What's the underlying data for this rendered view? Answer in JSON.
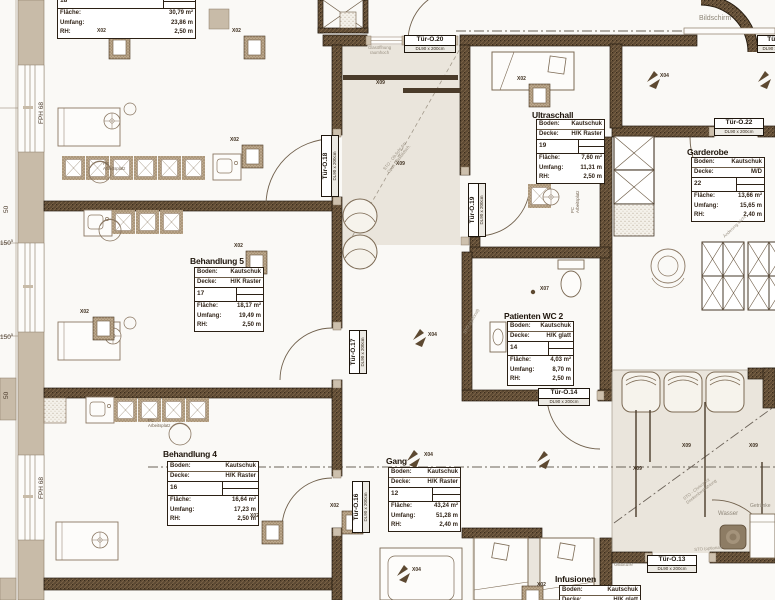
{
  "drawing": {
    "box_labels": {
      "boden": "Boden:",
      "decke": "Decke:",
      "flaeche": "Fläche:",
      "umfang": "Umfang:",
      "rh": "RH:"
    },
    "rooms": [
      {
        "id": "raum18",
        "title": "",
        "number": "18",
        "flaeche": "30,79 m²",
        "umfang": "23,86 m",
        "rh": "2,50 m"
      },
      {
        "id": "behandlung5",
        "title": "Behandlung 5",
        "boden": "Kautschuk",
        "decke": "H/K Raster",
        "number": "17",
        "flaeche": "18,17 m²",
        "umfang": "19,49 m",
        "rh": "2,50 m"
      },
      {
        "id": "behandlung4",
        "title": "Behandlung 4",
        "boden": "Kautschuk",
        "decke": "H/K Raster",
        "number": "16",
        "flaeche": "16,64 m²",
        "umfang": "17,23 m",
        "rh": "2,50 m"
      },
      {
        "id": "ultraschall",
        "title": "Ultraschall",
        "boden": "Kautschuk",
        "decke": "H/K Raster",
        "number": "19",
        "flaeche": "7,60 m²",
        "umfang": "11,31 m",
        "rh": "2,50 m"
      },
      {
        "id": "garderobe",
        "title": "Garderobe",
        "boden": "Kautschuk",
        "decke": "M/D",
        "number": "22",
        "flaeche": "13,66 m²",
        "umfang": "15,65 m",
        "rh": "2,40 m"
      },
      {
        "id": "patienten_wc_2",
        "title": "Patienten WC 2",
        "boden": "Kautschuk",
        "decke": "H/K glatt",
        "number": "14",
        "flaeche": "4,03 m²",
        "umfang": "8,70 m",
        "rh": "2,50 m"
      },
      {
        "id": "gang",
        "title": "Gang",
        "boden": "Kautschuk",
        "decke": "H/K Raster",
        "number": "12",
        "flaeche": "43,24 m²",
        "umfang": "51,28 m",
        "rh": "2,40 m"
      },
      {
        "id": "infusionen",
        "title": "Infusionen",
        "boden": "Kautschuk",
        "decke": "H/K glatt"
      }
    ],
    "doors": [
      {
        "name": "Tür-O.20",
        "size": "DL90 x 200cm"
      },
      {
        "name": "Tür-O.18",
        "size": "DL90 x 200cm"
      },
      {
        "name": "Tür-O.19",
        "size": "DL90 x 200cm"
      },
      {
        "name": "Tür-O.22",
        "size": "DL90 x 200cm"
      },
      {
        "name": "Tür-O.17",
        "size": "DL90 x 200cm"
      },
      {
        "name": "Tür-O.16",
        "size": "DL90 x 200cm"
      },
      {
        "name": "Tür-O.14",
        "size": "DL90 x 200cm"
      },
      {
        "name": "Tür-O.13",
        "size": "DL90 x 200cm"
      },
      {
        "name": "Tür-O.",
        "size": "DL90 x 200cm"
      }
    ],
    "markers": {
      "x02": "X02",
      "x04": "X04",
      "x07": "X07",
      "x09": "X09"
    },
    "annotations": {
      "bildschirm": "Bildschirm",
      "glasoeffnung1": "Glasöffnung",
      "glasoeffnung2": "raumhoch",
      "glastuere": "Glastüre",
      "wasser": "Wasser",
      "getraenke": "Getränke",
      "pc_line1": "PC",
      "pc_line2": "Arbeitsplatz",
      "diag1a": "STO - Ob.licht 4m",
      "diag1b": "Opak Glasbildsch.",
      "diag2a": "STO - Chricot rot",
      "diag2b": "Deckenbestrahlung",
      "diag3": "Änderung leicht",
      "sto_optional": "STO (optional)"
    },
    "dimensions": {
      "fph": "FPH 68",
      "d50": "50",
      "d150": "150",
      "d150sup": "5"
    },
    "colors": {
      "wall": "#5c4933",
      "beige_room": "#eae5dc",
      "column": "#c8bba8",
      "ink": "#2b2014",
      "grey_note": "#8e8678"
    }
  }
}
